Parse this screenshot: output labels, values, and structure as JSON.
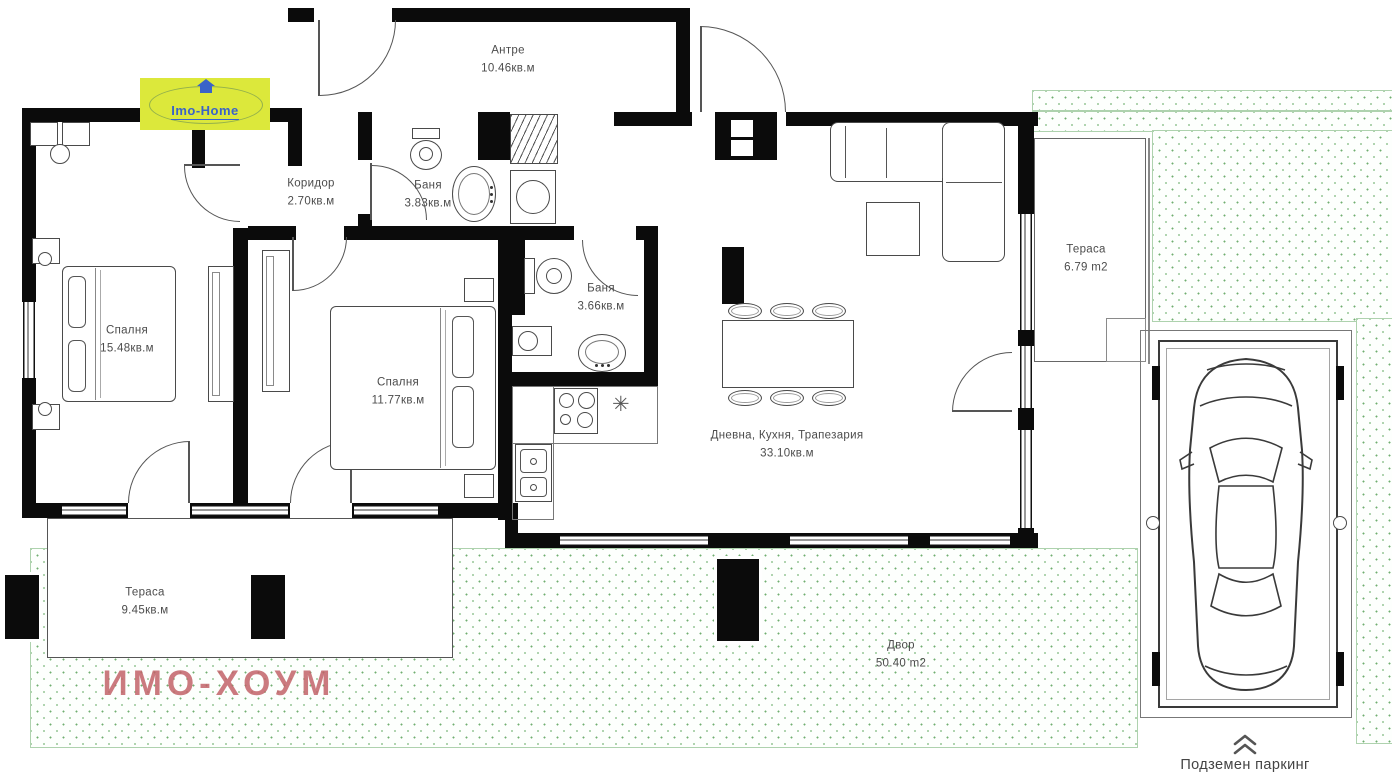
{
  "title": "Apartment floor plan",
  "logo": {
    "text": "Imo-Home"
  },
  "rooms": {
    "antre": {
      "name": "Антре",
      "area": "10.46кв.м"
    },
    "koridor": {
      "name": "Коридор",
      "area": "2.70кв.м"
    },
    "banya1": {
      "name": "Баня",
      "area": "3.83кв.м"
    },
    "spalnya1": {
      "name": "Спалня",
      "area": "15.48кв.м"
    },
    "spalnya2": {
      "name": "Спалня",
      "area": "11.77кв.м"
    },
    "banya2": {
      "name": "Баня",
      "area": "3.66кв.м"
    },
    "living": {
      "name": "Дневна, Кухня, Трапезария",
      "area": "33.10кв.м"
    },
    "terasa_top": {
      "name": "Тераса",
      "area": "6.79 m2"
    },
    "terasa_bottom": {
      "name": "Тераса",
      "area": "9.45кв.м"
    },
    "dvor": {
      "name": "Двор",
      "area": "50.40 m2"
    }
  },
  "annotations": {
    "parking": "Подземен паркинг",
    "watermark": "ИМО-ХОУМ"
  },
  "colors": {
    "wall": "#0b0b0b",
    "grass_dot": "#6fae6f",
    "watermark": "#c26368",
    "logo_bg": "#dce83b",
    "logo_text": "#3a63c8"
  }
}
